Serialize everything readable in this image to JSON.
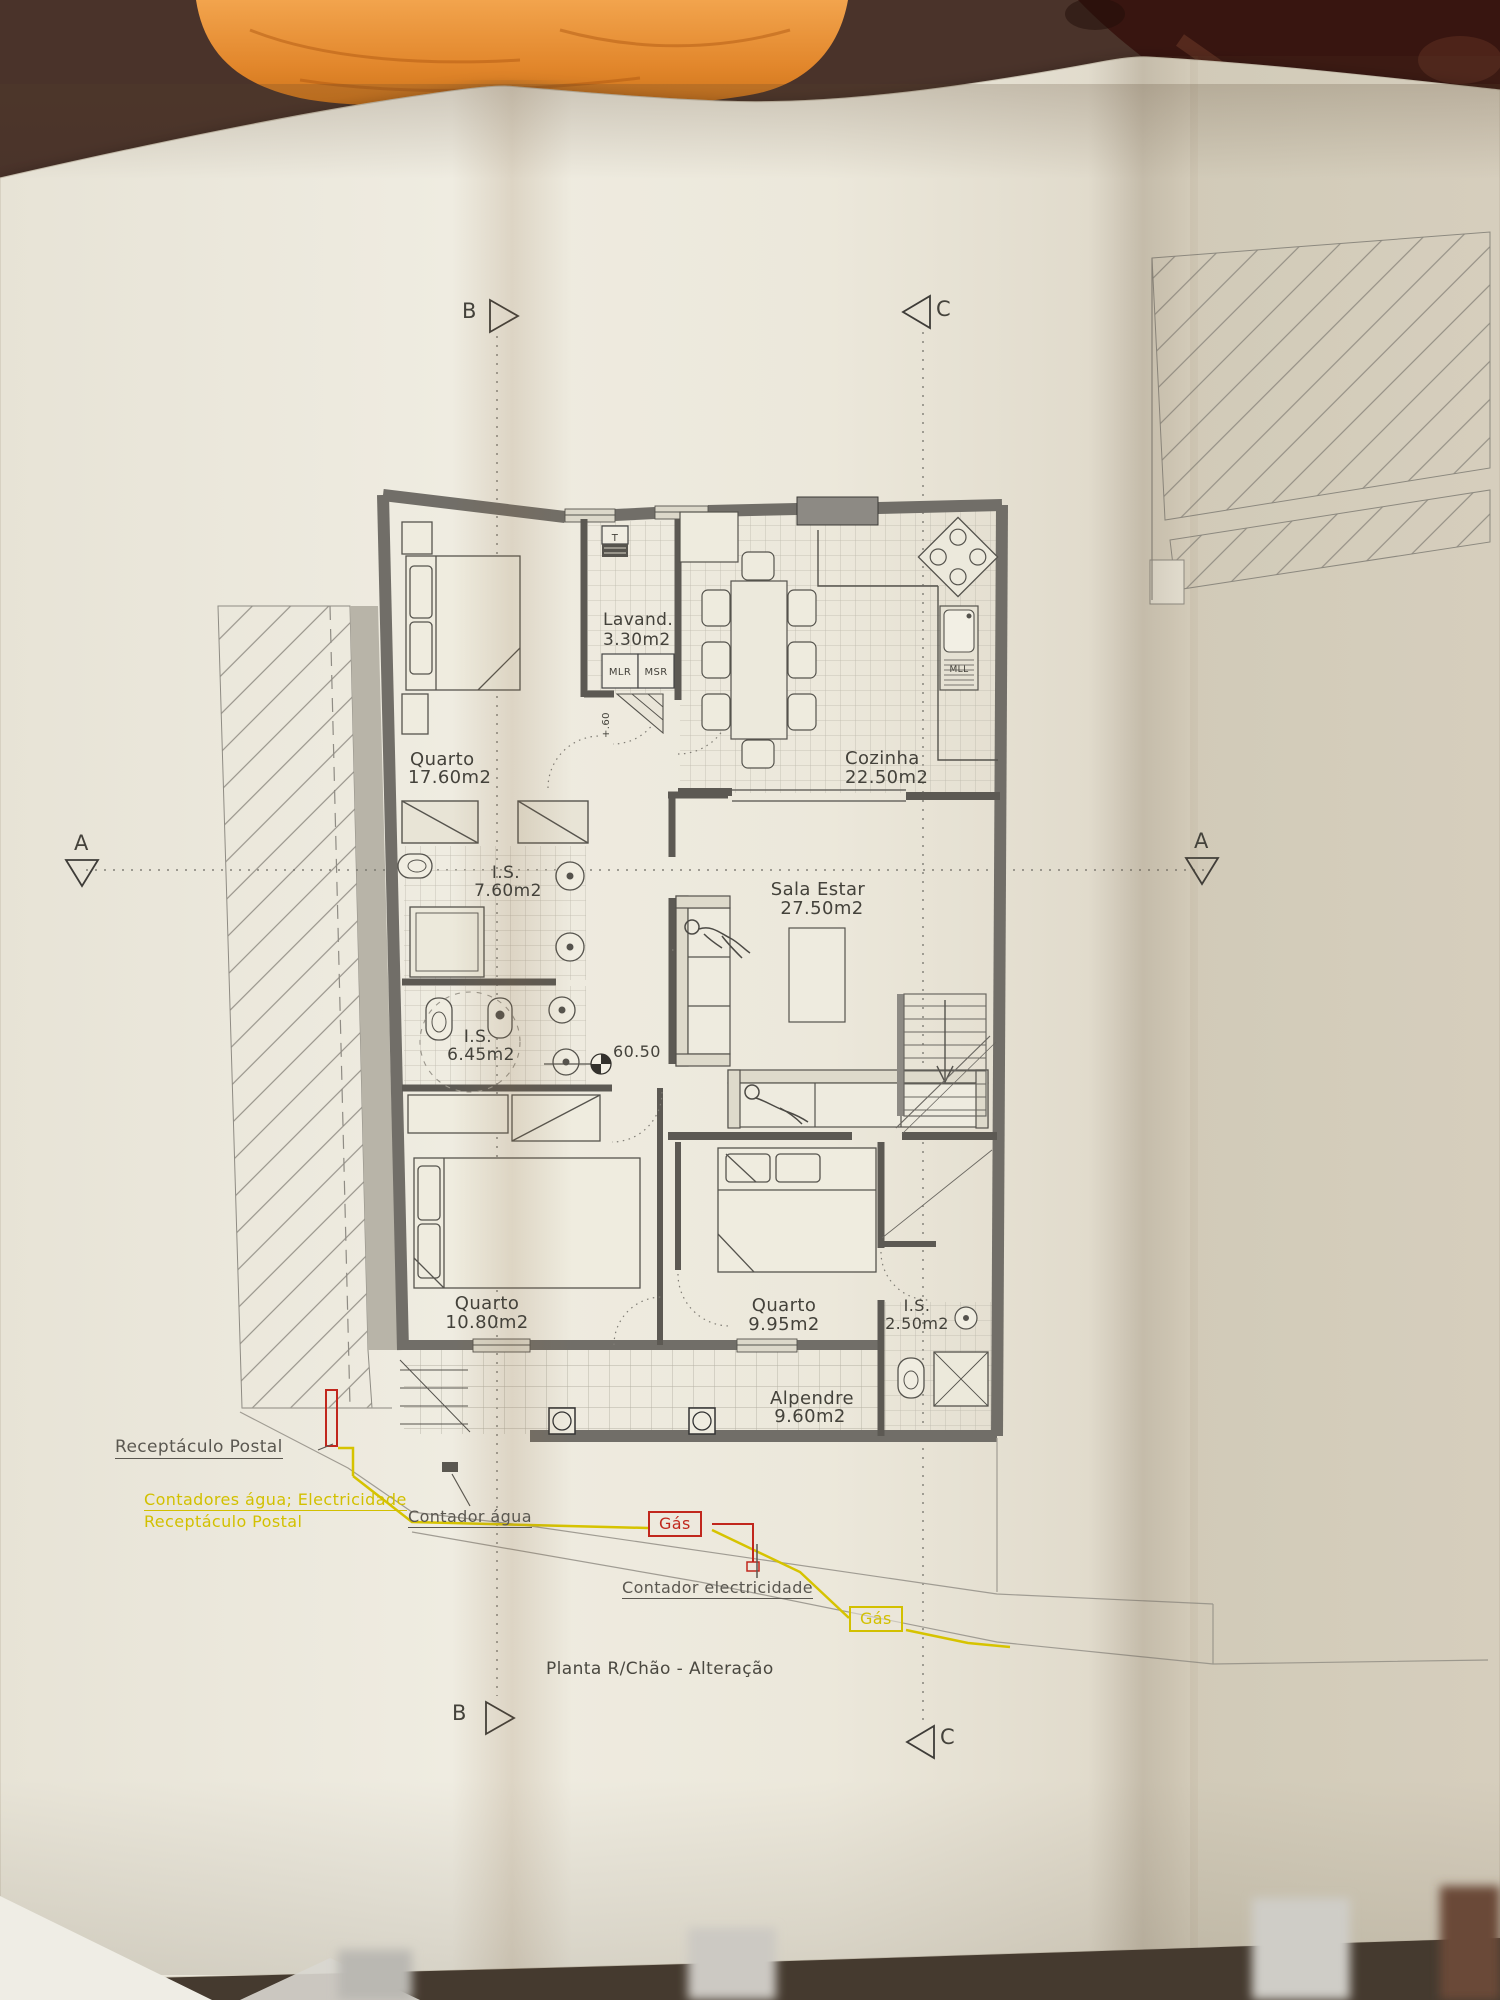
{
  "title": "Planta R/Chão - Alteração",
  "rooms": [
    {
      "name": "Quarto",
      "area": "17.60m2"
    },
    {
      "name": "Lavand.",
      "area": "3.30m2"
    },
    {
      "name": "Cozinha",
      "area": "22.50m2"
    },
    {
      "name": "I.S.",
      "area": "7.60m2"
    },
    {
      "name": "I.S.",
      "area": "6.45m2"
    },
    {
      "name": "Sala Estar",
      "area": "27.50m2"
    },
    {
      "name": "Quarto",
      "area": "10.80m2"
    },
    {
      "name": "Quarto",
      "area": "9.95m2"
    },
    {
      "name": "I.S.",
      "area": "2.50m2"
    },
    {
      "name": "Alpendre",
      "area": "9.60m2"
    }
  ],
  "labels": {
    "t": "T",
    "mlr": "MLR",
    "msr": "MSR",
    "mll": "MLL",
    "elevation": "60.50",
    "step_height": "+.60"
  },
  "markers": {
    "a": "A",
    "b": "B",
    "c": "C"
  },
  "annotations": {
    "receptaculo_postal": "Receptáculo Postal",
    "contadores": "Contadores água; Electricidade",
    "receptaculo_postal_2": "Receptáculo Postal",
    "contador_agua": "Contador água",
    "contador_electricidade": "Contador electricidade",
    "gas": "Gás"
  },
  "colors": {
    "paper": "#ebe7db",
    "ink": "#44423b",
    "wall_gray": "#716e68",
    "accent_yellow": "#d2c000",
    "accent_red": "#c1271d",
    "cloth_orange": "#e2872c",
    "table_brown": "#4a332a",
    "peeling_wall_maroon": "#381510"
  }
}
